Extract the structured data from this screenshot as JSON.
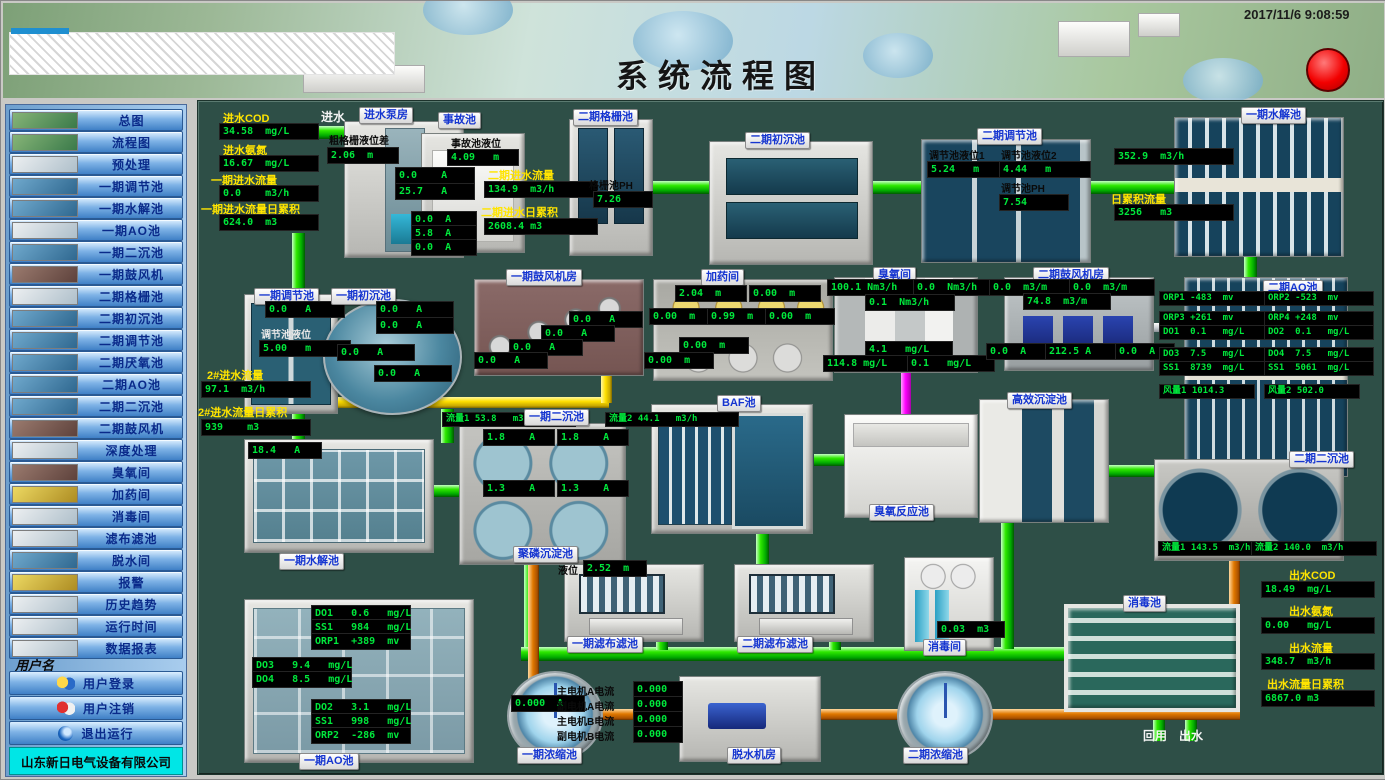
{
  "header": {
    "title": "系统流程图",
    "timestamp": "2017/11/6 9:08:59"
  },
  "sidebar": {
    "items": [
      {
        "label": "总图"
      },
      {
        "label": "流程图"
      },
      {
        "label": "预处理"
      },
      {
        "label": "一期调节池"
      },
      {
        "label": "一期水解池"
      },
      {
        "label": "一期AO池"
      },
      {
        "label": "一期二沉池"
      },
      {
        "label": "一期鼓风机"
      },
      {
        "label": "二期格栅池"
      },
      {
        "label": "二期初沉池"
      },
      {
        "label": "二期调节池"
      },
      {
        "label": "二期厌氧池"
      },
      {
        "label": "二期AO池"
      },
      {
        "label": "二期二沉池"
      },
      {
        "label": "二期鼓风机"
      },
      {
        "label": "深度处理"
      },
      {
        "label": "臭氧间"
      },
      {
        "label": "加药间"
      },
      {
        "label": "消毒间"
      },
      {
        "label": "滤布滤池"
      },
      {
        "label": "脱水间"
      },
      {
        "label": "报警"
      },
      {
        "label": "历史趋势"
      },
      {
        "label": "运行时间"
      },
      {
        "label": "数据报表"
      }
    ],
    "username_label": "用户名",
    "login": "用户登录",
    "logout": "用户注销",
    "exit": "退出运行",
    "company": "山东新日电气设备有限公司"
  },
  "d": {
    "inlet": {
      "cod_label": "进水COD",
      "cod": "34.58  mg/L",
      "nh3_label": "进水氨氮",
      "nh3": "16.67  mg/L",
      "flow_label": "一期进水流量",
      "flow": "0.0    m3/h",
      "acc_label": "一期进水流量日累积",
      "acc": "624.0  m3",
      "in_label": "进水"
    },
    "pump": {
      "tag": "进水泵房",
      "screen_label": "粗格栅液位差",
      "screen": "2.06  m",
      "a1": "0.0    A",
      "a2": "25.7   A",
      "a3": "0.0  A",
      "a4": "5.8  A",
      "a5": "0.0  A"
    },
    "accident": {
      "tag": "事故池",
      "lv_label": "事故池液位",
      "lv": "4.09   m"
    },
    "in2": {
      "flow_label": "二期进水流量",
      "flow": "134.9  m3/h",
      "acc_label": "二期进水日累积",
      "acc": "2608.4 m3"
    },
    "grid": {
      "tag": "二期格栅池",
      "ph_label": "格栅池PH",
      "ph": "7.26"
    },
    "sed2a": {
      "tag": "二期初沉池"
    },
    "reg2": {
      "tag": "二期调节池",
      "lv1_label": "调节池液位1",
      "lv1": "5.24   m",
      "lv2_label": "调节池液位2",
      "lv2": "4.44   m",
      "ph_label": "调节池PH",
      "ph": "7.54"
    },
    "hydro1": {
      "tag": "一期水解池",
      "flow": "352.9  m3/h",
      "acc_label": "日累积流量",
      "acc": "3256   m3"
    },
    "reg1": {
      "tag": "一期调节池",
      "a": "0.0   A",
      "lv_label": "调节池液位",
      "lv": "5.00   m"
    },
    "sed1a": {
      "tag": "一期初沉池",
      "a1": "0.0   A",
      "a2": "0.0   A",
      "a3": "0.0   A",
      "a4": "0.0   A"
    },
    "in2b": {
      "flow_label": "2#进水流量",
      "flow": "97.1  m3/h",
      "acc_label": "2#进水流量日累积",
      "acc": "939    m3"
    },
    "blower1": {
      "tag": "一期鼓风机房",
      "a1": "0.0   A",
      "a2": "0.0   A",
      "a3": "0.0   A",
      "a4": "0.0   A"
    },
    "dosing": {
      "tag": "加药间",
      "v1": "2.04  m",
      "v2": "0.00  m",
      "v3": "0.00  m",
      "v4": "0.99  m",
      "v5": "0.00  m",
      "v6": "0.00  m",
      "v7": "0.00  m"
    },
    "ozone": {
      "tag": "臭氧间",
      "f1": "100.1 Nm3/h",
      "f2": "0.0  Nm3/h",
      "f3": "0.1  Nm3/h",
      "c1": "4.1   mg/L",
      "c2": "114.8 mg/L",
      "c3": "0.1   mg/L"
    },
    "blower2": {
      "tag": "二期鼓风机房",
      "f1": "0.0  m3/m",
      "f2": "0.0  m3/m",
      "f3": "74.8  m3/m",
      "a1": "0.0  A",
      "a2": "212.5 A",
      "a3": "0.0  A"
    },
    "ao2": {
      "tag": "二期AO池",
      "orp1": "ORP1 -483  mv",
      "orp2": "ORP2 -523  mv",
      "orp3": "ORP3 +261  mv",
      "orp4": "ORP4 +248  mv",
      "do1": "DO1  0.1   mg/L",
      "do2": "DO2  0.1   mg/L",
      "do3": "DO3  7.5   mg/L",
      "do4": "DO4  7.5   mg/L",
      "ss1": "SS1  8739  mg/L",
      "ss2": "SS1  5061  mg/L",
      "air1": "风量1 1014.3",
      "air2": "风量2 502.0"
    },
    "hydro1b": {
      "tag": "一期水解池",
      "a": "18.4   A"
    },
    "sed1b": {
      "tag": "一期二沉池",
      "flow1": "流量1 53.8   m3/h",
      "flow2": "流量2 44.1   m3/h",
      "a1": "1.8    A",
      "a2": "1.8    A",
      "a3": "1.3    A",
      "a4": "1.3    A"
    },
    "poly": {
      "tag": "聚磷沉淀池"
    },
    "baf": {
      "tag": "BAF池"
    },
    "ozreact": {
      "tag": "臭氧反应池"
    },
    "hes": {
      "tag": "高效沉淀池"
    },
    "sed2b": {
      "tag": "二期二沉池",
      "flow1": "流量1 143.5  m3/h",
      "flow2": "流量2 140.0  m3/h"
    },
    "ao1": {
      "tag": "一期AO池",
      "do1": "DO1   0.6   mg/L",
      "ss1": "SS1   984   mg/L",
      "orp1": "ORP1  +389  mv",
      "do3": "DO3   9.4   mg/L",
      "do4": "DO4   8.5   mg/L",
      "do2": "DO2   3.1   mg/L",
      "ss2": "SS1   998   mg/L",
      "orp2": "ORP2  -286  mv"
    },
    "filt1": {
      "tag": "一期滤布滤池",
      "lv_label": "液位",
      "lv": "2.52  m"
    },
    "filt2": {
      "tag": "二期滤布滤池"
    },
    "disroom": {
      "tag": "消毒间",
      "v": "0.03  m3"
    },
    "dispool": {
      "tag": "消毒池"
    },
    "thick1": {
      "tag": "一期浓缩池",
      "a": "0.000  A"
    },
    "dewater": {
      "tag": "脱水机房",
      "m1": "主电机A电流",
      "m2": "副电机A电流",
      "m3": "主电机B电流",
      "m4": "副电机B电流",
      "v1": "0.000",
      "v2": "0.000",
      "v3": "0.000",
      "v4": "0.000"
    },
    "thick2": {
      "tag": "二期浓缩池"
    },
    "out": {
      "reuse": "回用",
      "outflow": "出水",
      "cod_label": "出水COD",
      "cod": "18.49  mg/L",
      "nh3_label": "出水氨氮",
      "nh3": "0.00   mg/L",
      "flow_label": "出水流量",
      "flow": "348.7  m3/h",
      "acc_label": "出水流量日累积",
      "acc": "6867.0 m3"
    }
  },
  "colors": {
    "led_green": "#00e83c",
    "label_yellow": "#ffe400",
    "pipe_green": "#00a800",
    "pipe_orange": "#d47000",
    "pipe_yellow": "#ffd800",
    "pipe_magenta": "#ff00ff",
    "alarm_red": "#f20000"
  }
}
